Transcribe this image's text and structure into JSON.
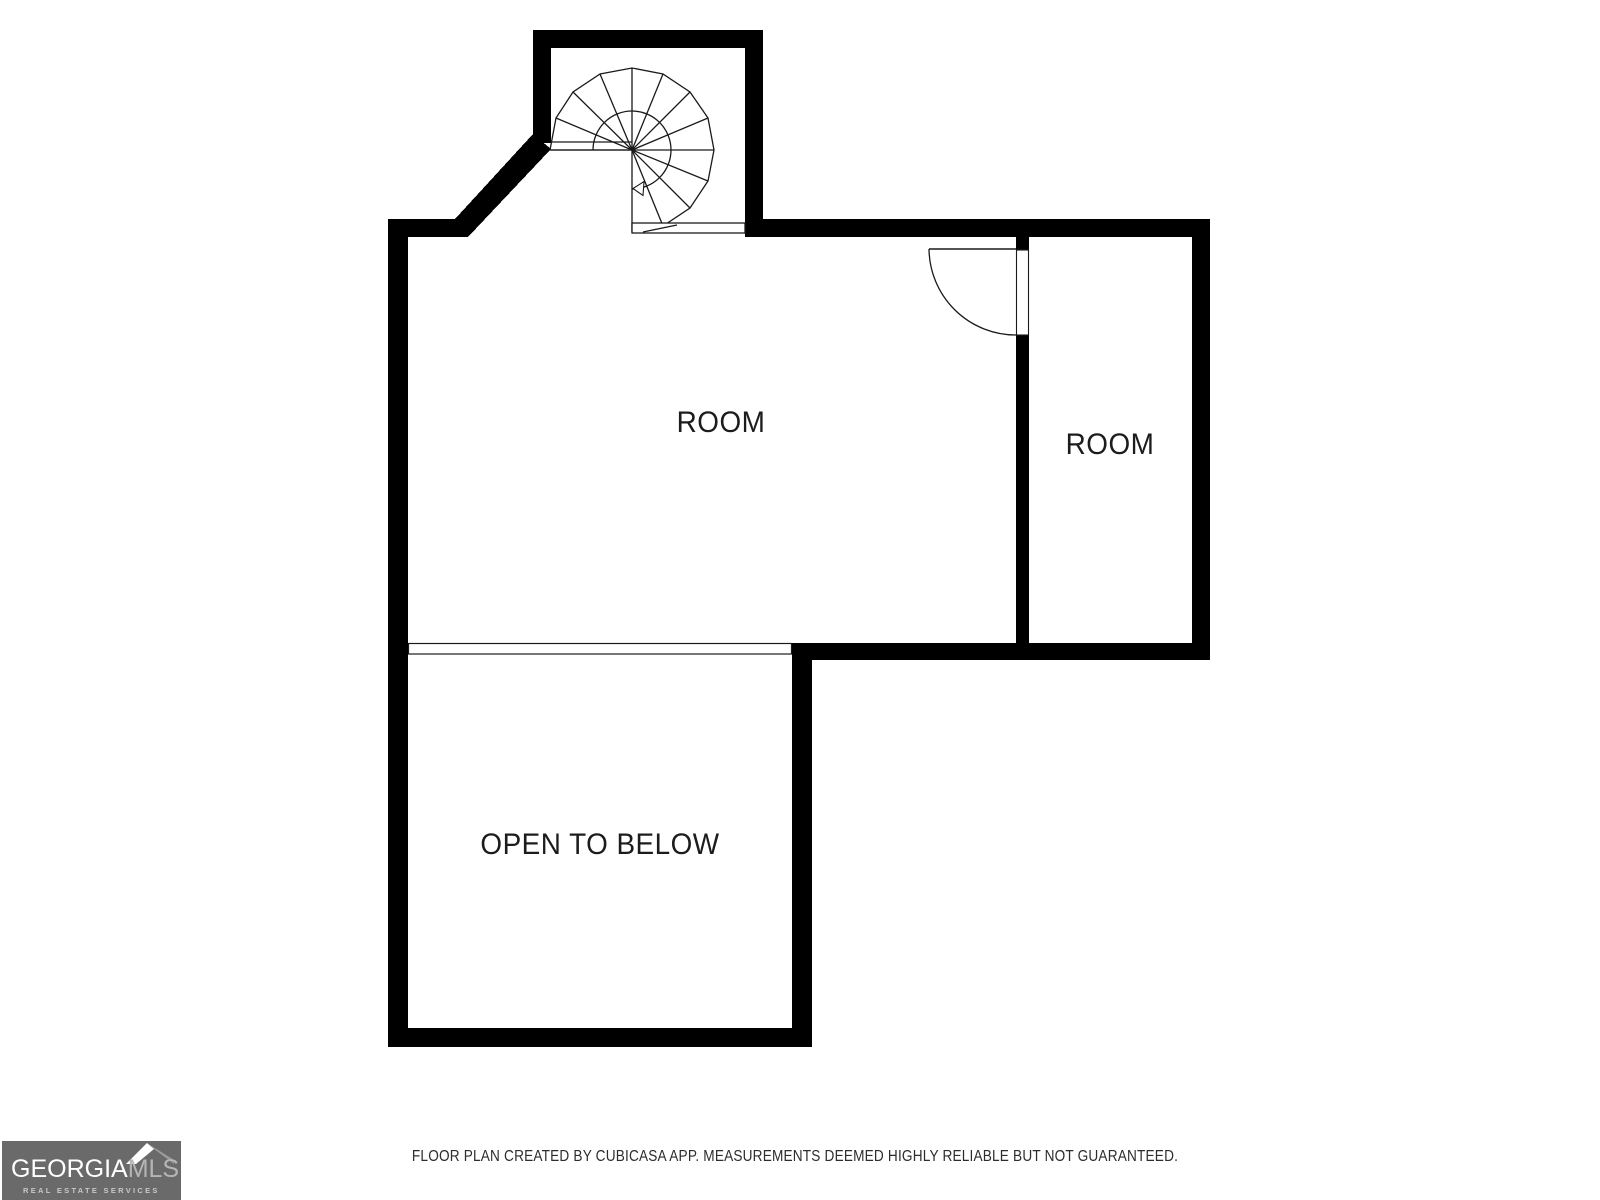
{
  "plan": {
    "rooms": [
      {
        "label": "ROOM"
      },
      {
        "label": "ROOM"
      },
      {
        "label": "OPEN TO BELOW"
      }
    ]
  },
  "footer": {
    "disclaimer": "FLOOR PLAN CREATED BY CUBICASA APP. MEASUREMENTS DEEMED HIGHLY RELIABLE BUT NOT GUARANTEED."
  },
  "logo": {
    "brand_primary": "GEORGIA",
    "brand_secondary": "MLS",
    "tagline": "REAL ESTATE SERVICES"
  },
  "colors": {
    "wall": "#000000",
    "thin_line": "#1a1a1a",
    "label_text": "#1c1c1c",
    "disclaimer_text": "#2d2d2d",
    "logo_background": "#6b6a6a",
    "logo_primary_text": "#ffffff",
    "logo_secondary_text": "#b5b5b5",
    "logo_roof_highlight": "#ffffff",
    "logo_roof_shadow": "#9b9b9b",
    "page_background": "#ffffff"
  }
}
